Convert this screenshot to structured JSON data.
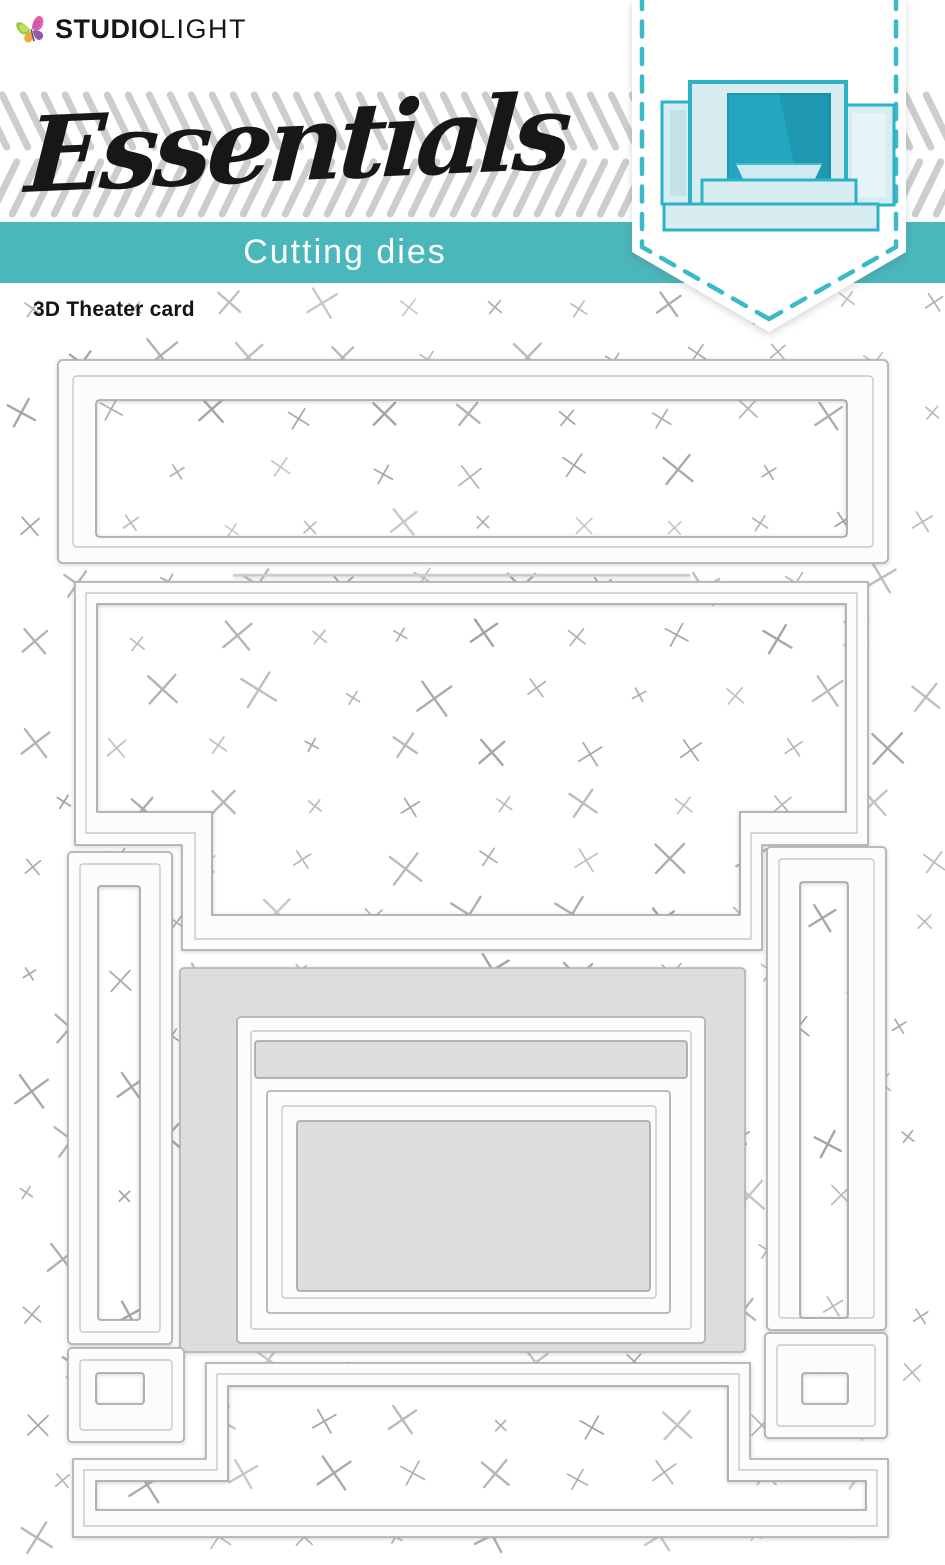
{
  "brand": {
    "name_bold": "STUDIO",
    "name_light": "LIGHT",
    "butterfly_icon": "butterfly-icon"
  },
  "series": {
    "title": "Essentials"
  },
  "category_band": {
    "label": "Cutting dies"
  },
  "product": {
    "name": "3D Theater card"
  },
  "colors": {
    "teal_band": "#4ab7bc",
    "pennant_dash": "#3ab9c6",
    "card_teal": "#2eb2c8",
    "card_pale": "#d7edf1",
    "card_window": "#23a6c0",
    "die_outline": "#b1b2b4",
    "die_mid": "#c7c8ca",
    "die_fill": "#fcfcfd",
    "plate_gray": "#dcddde",
    "mark_gray": "#96969a",
    "stripe_gray": "#cdcdcf",
    "text_black": "#171717"
  }
}
